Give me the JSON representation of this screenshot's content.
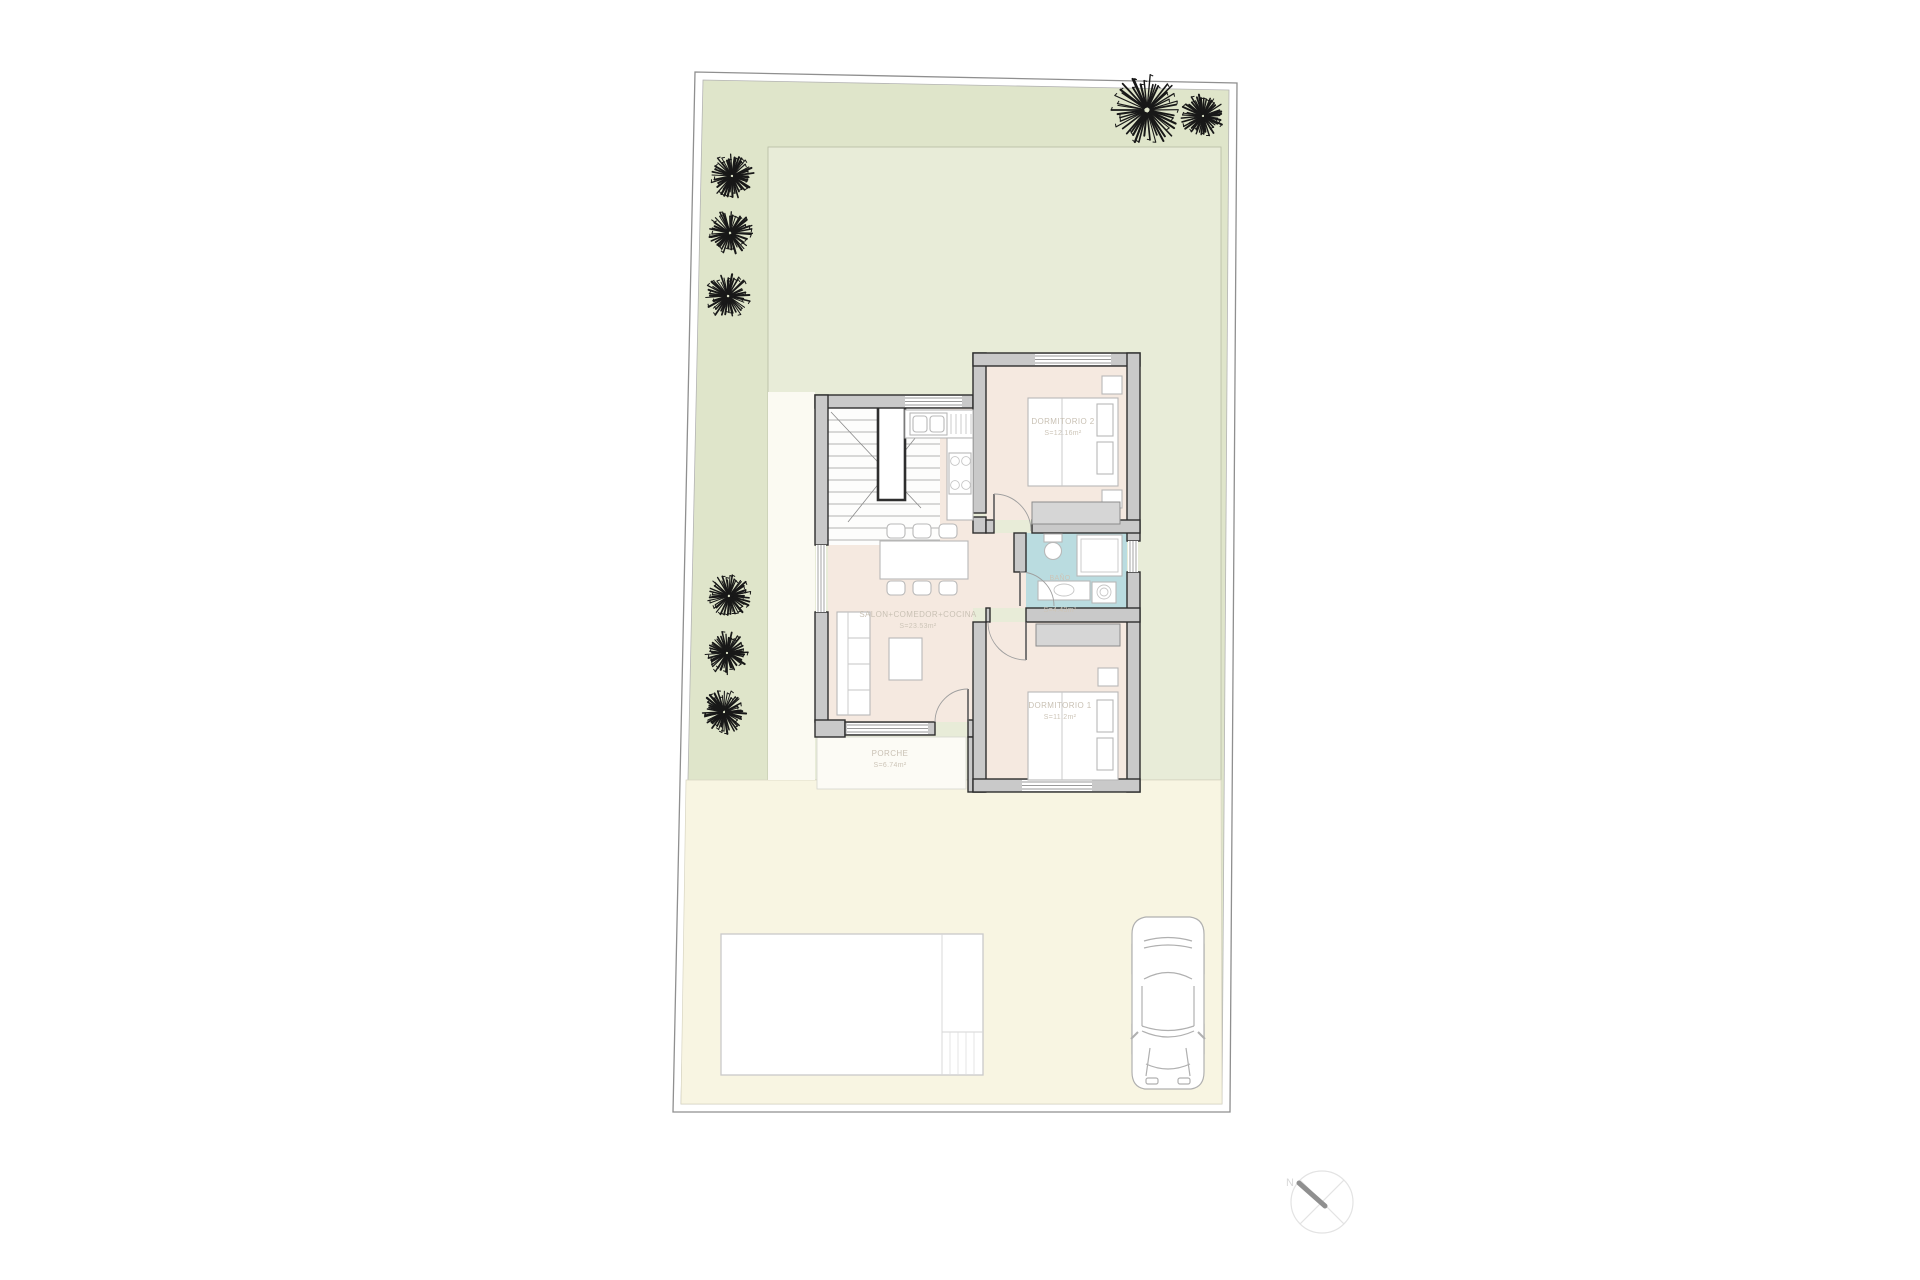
{
  "document": {
    "type": "site-floor-plan",
    "background": "#ffffff"
  },
  "rooms": {
    "dormitorio2": {
      "name": "DORMITORIO 2",
      "area": "S=12.16m²"
    },
    "dormitorio1": {
      "name": "DORMITORIO 1",
      "area": "S=11.2m²"
    },
    "salon": {
      "name": "SALON+COMEDOR+COCINA",
      "area": "S=23.53m²"
    },
    "bano": {
      "name": "BAÑO",
      "area": "S=4.43m²"
    },
    "porche": {
      "name": "PORCHE",
      "area": "S=6.74m²"
    }
  },
  "compass": {
    "north_label": "N"
  },
  "colors": {
    "plot_border": "#8f8f8f",
    "garden_dark_green": "#dfe5ca",
    "garden_light_green": "#e8ecd8",
    "driveway_cream": "#f8f5e2",
    "walkway": "#fbfaf2",
    "interior_floor": "#f5e9e0",
    "bathroom_floor": "#badce0",
    "wall_fill": "#c9c9c9",
    "wall_stroke": "#2e2e2e",
    "tree_ink": "#181818",
    "label_text": "#c9c1b4"
  },
  "trees": [
    {
      "x": 732,
      "y": 176,
      "r": 22
    },
    {
      "x": 730,
      "y": 233,
      "r": 22
    },
    {
      "x": 728,
      "y": 296,
      "r": 22
    },
    {
      "x": 729,
      "y": 596,
      "r": 21
    },
    {
      "x": 727,
      "y": 653,
      "r": 21
    },
    {
      "x": 724,
      "y": 712,
      "r": 21
    },
    {
      "x": 1147,
      "y": 110,
      "r": 34
    },
    {
      "x": 1203,
      "y": 116,
      "r": 21
    }
  ]
}
